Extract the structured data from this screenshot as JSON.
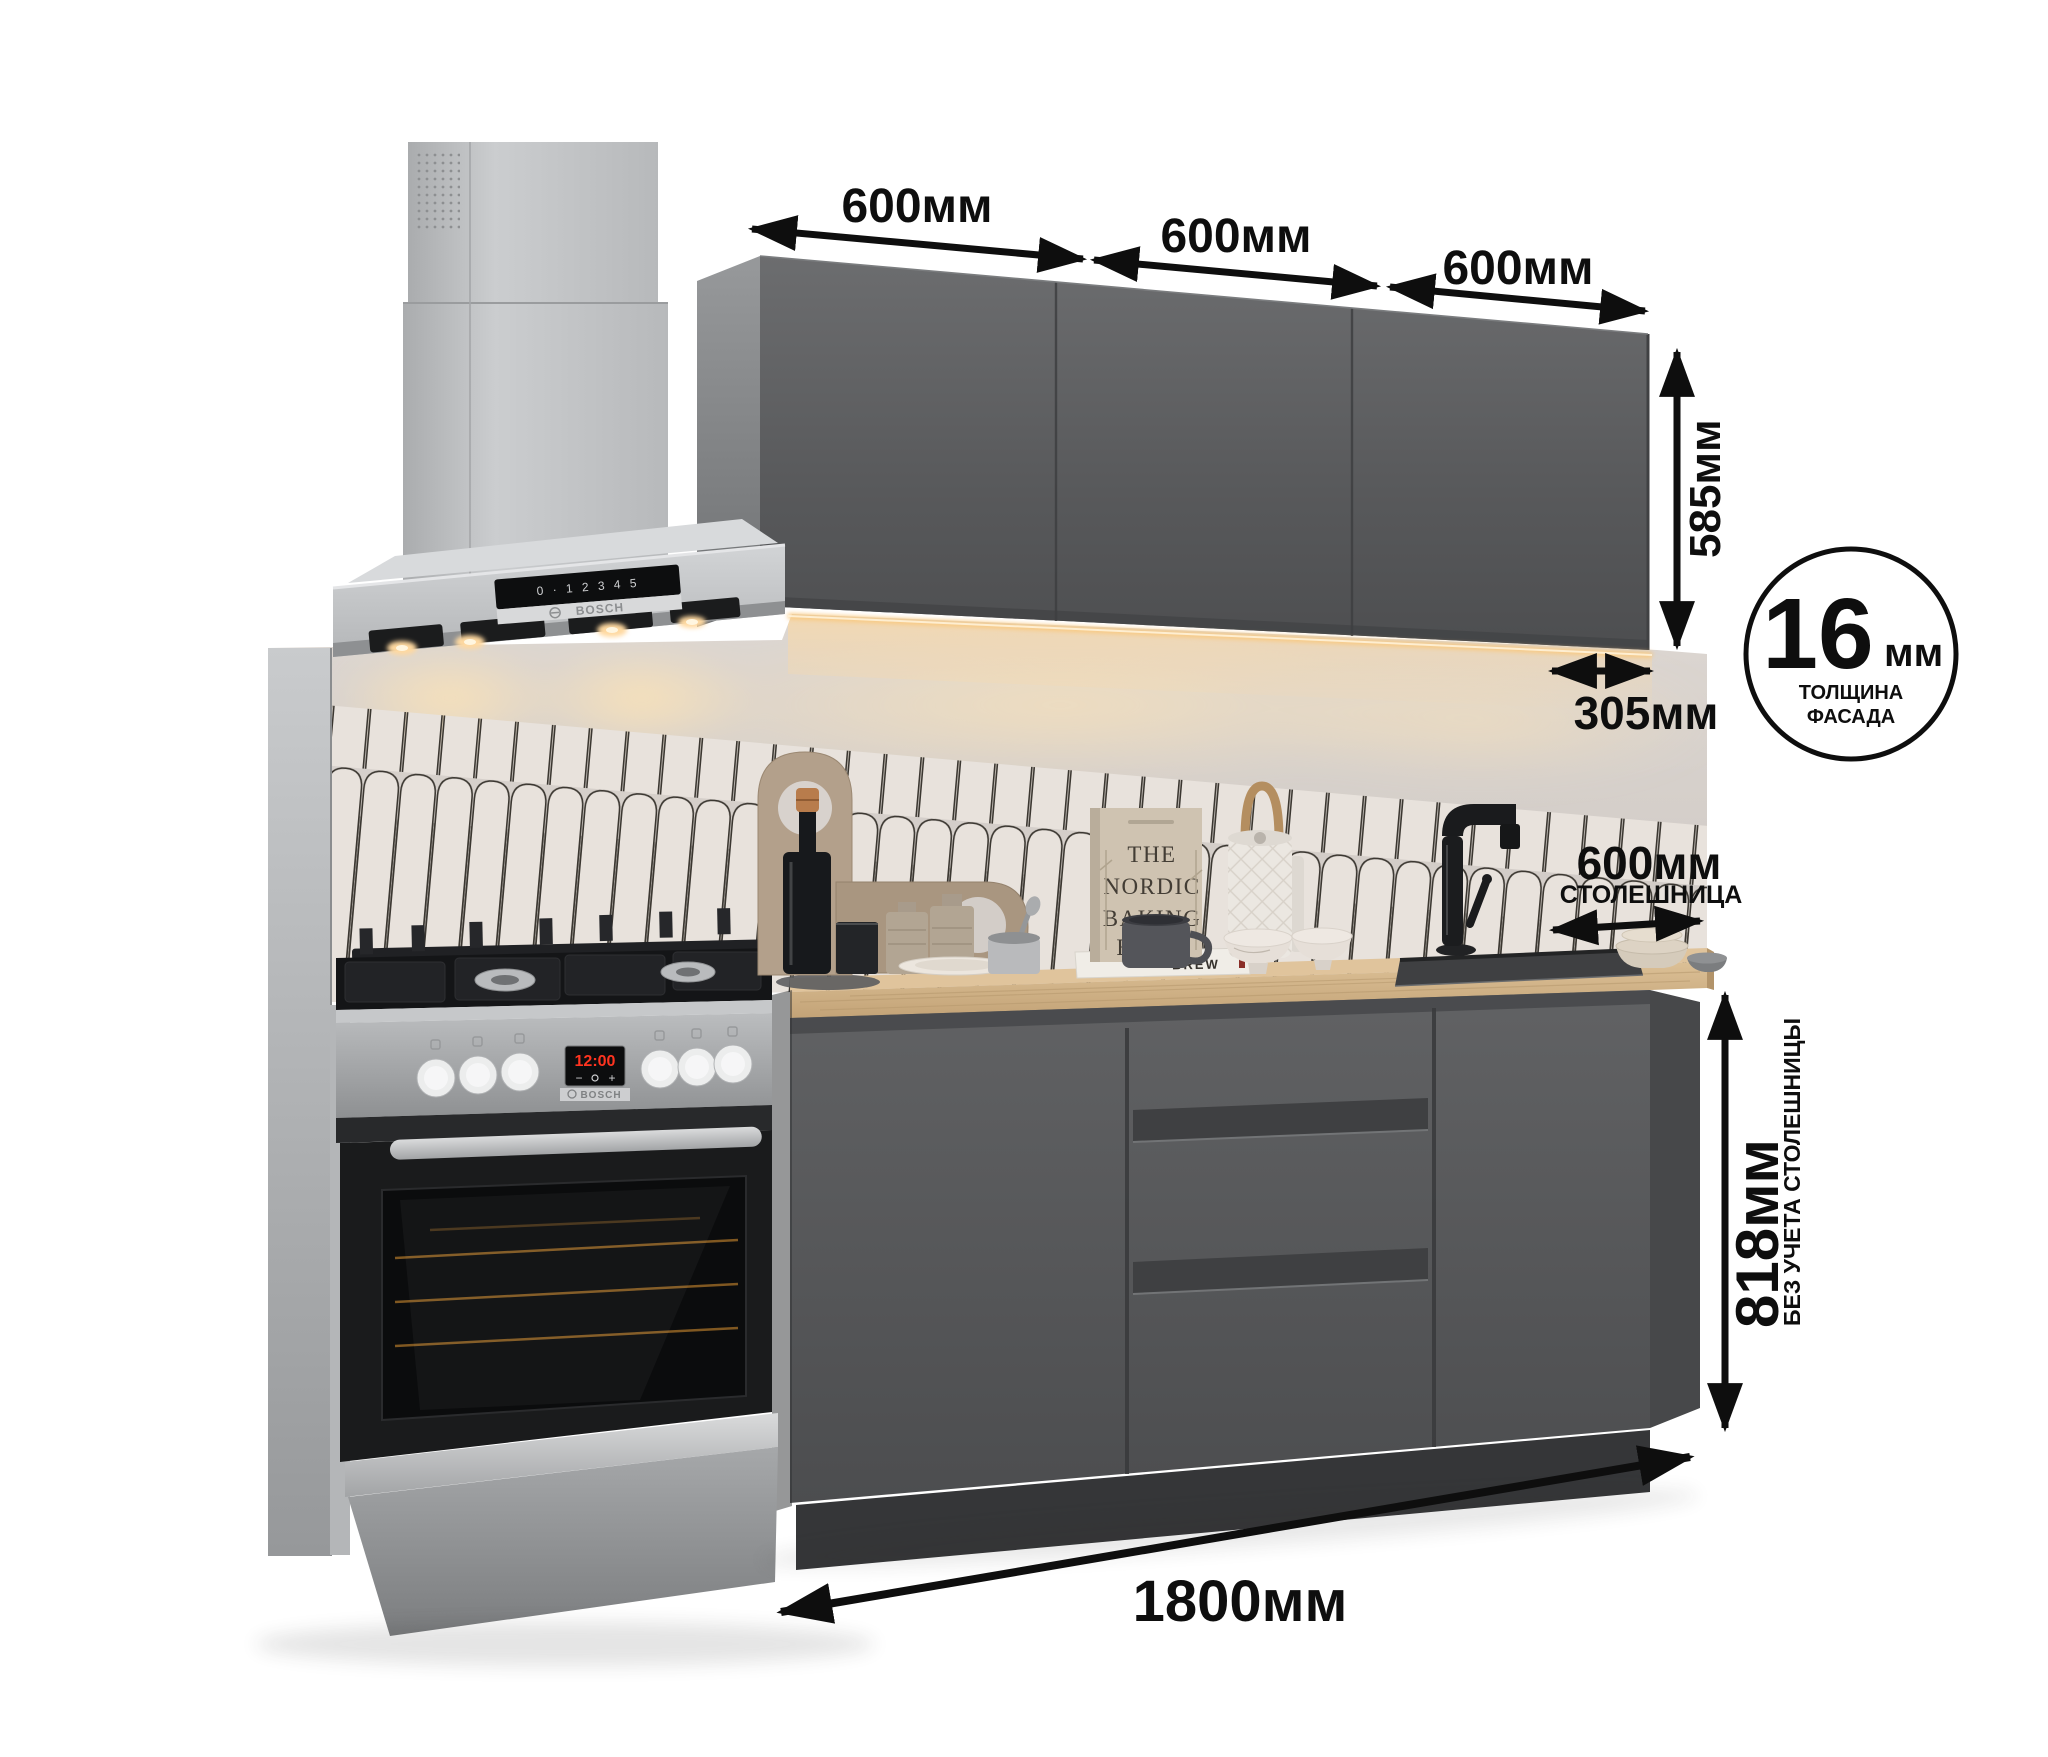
{
  "dim": {
    "w1": "600мм",
    "w2": "600мм",
    "w3": "600мм",
    "h585": "585мм",
    "d305": "305мм",
    "c600": "600мм",
    "c600_label": "СТОЛЕШНИЦА",
    "h818": "818мм",
    "h818_note": "БЕЗ УЧЕТА СТОЛЕШНИЦЫ",
    "total": "1800мм",
    "facade_value": "16",
    "facade_unit": "мм",
    "facade_line1": "ТОЛЩИНА",
    "facade_line2": "ФАСАДА"
  },
  "app": {
    "hood_brand": "BOSCH",
    "hood_panel": "0 · 1 2 3 4 5",
    "stove_brand": "BOSCH",
    "stove_time": "12:00",
    "stove_minus": "−",
    "stove_plus": "+"
  },
  "decor": {
    "book_line1": "THE",
    "book_line2": "NORDIC",
    "book_line3": "BAKING",
    "book_line4": "BOOK",
    "book_flat": "BREW"
  },
  "colors": {
    "annotation": "#0e0e0e",
    "cabinet": "#5a5b5d",
    "tile": "#e8e2dc",
    "wall": "#d7d1cc",
    "countertop": "#d2b284",
    "led": "#f9c87d",
    "display_red": "#ff3420"
  }
}
